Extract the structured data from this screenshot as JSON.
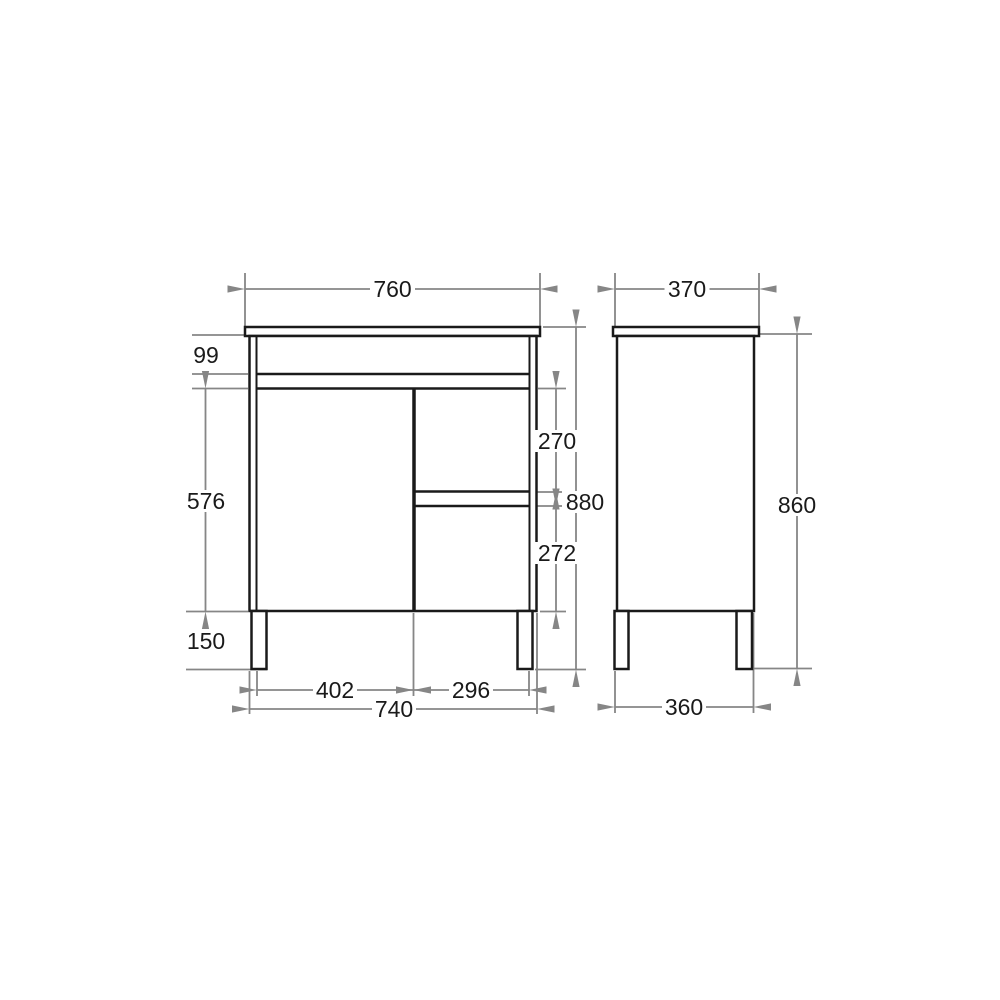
{
  "colors": {
    "background": "#ffffff",
    "outline": "#1a1a1a",
    "dimension_lines": "#868686",
    "label_text": "#1a1a1a"
  },
  "front_view": {
    "top_width": "760",
    "top_rail_height": "99",
    "door_height": "576",
    "leg_height": "150",
    "top_drawer_height": "270",
    "bottom_drawer_height": "272",
    "overall_height": "880",
    "door_width": "402",
    "drawer_width": "296",
    "cabinet_width": "740"
  },
  "side_view": {
    "top_depth": "370",
    "cabinet_height": "860",
    "base_depth": "360"
  }
}
